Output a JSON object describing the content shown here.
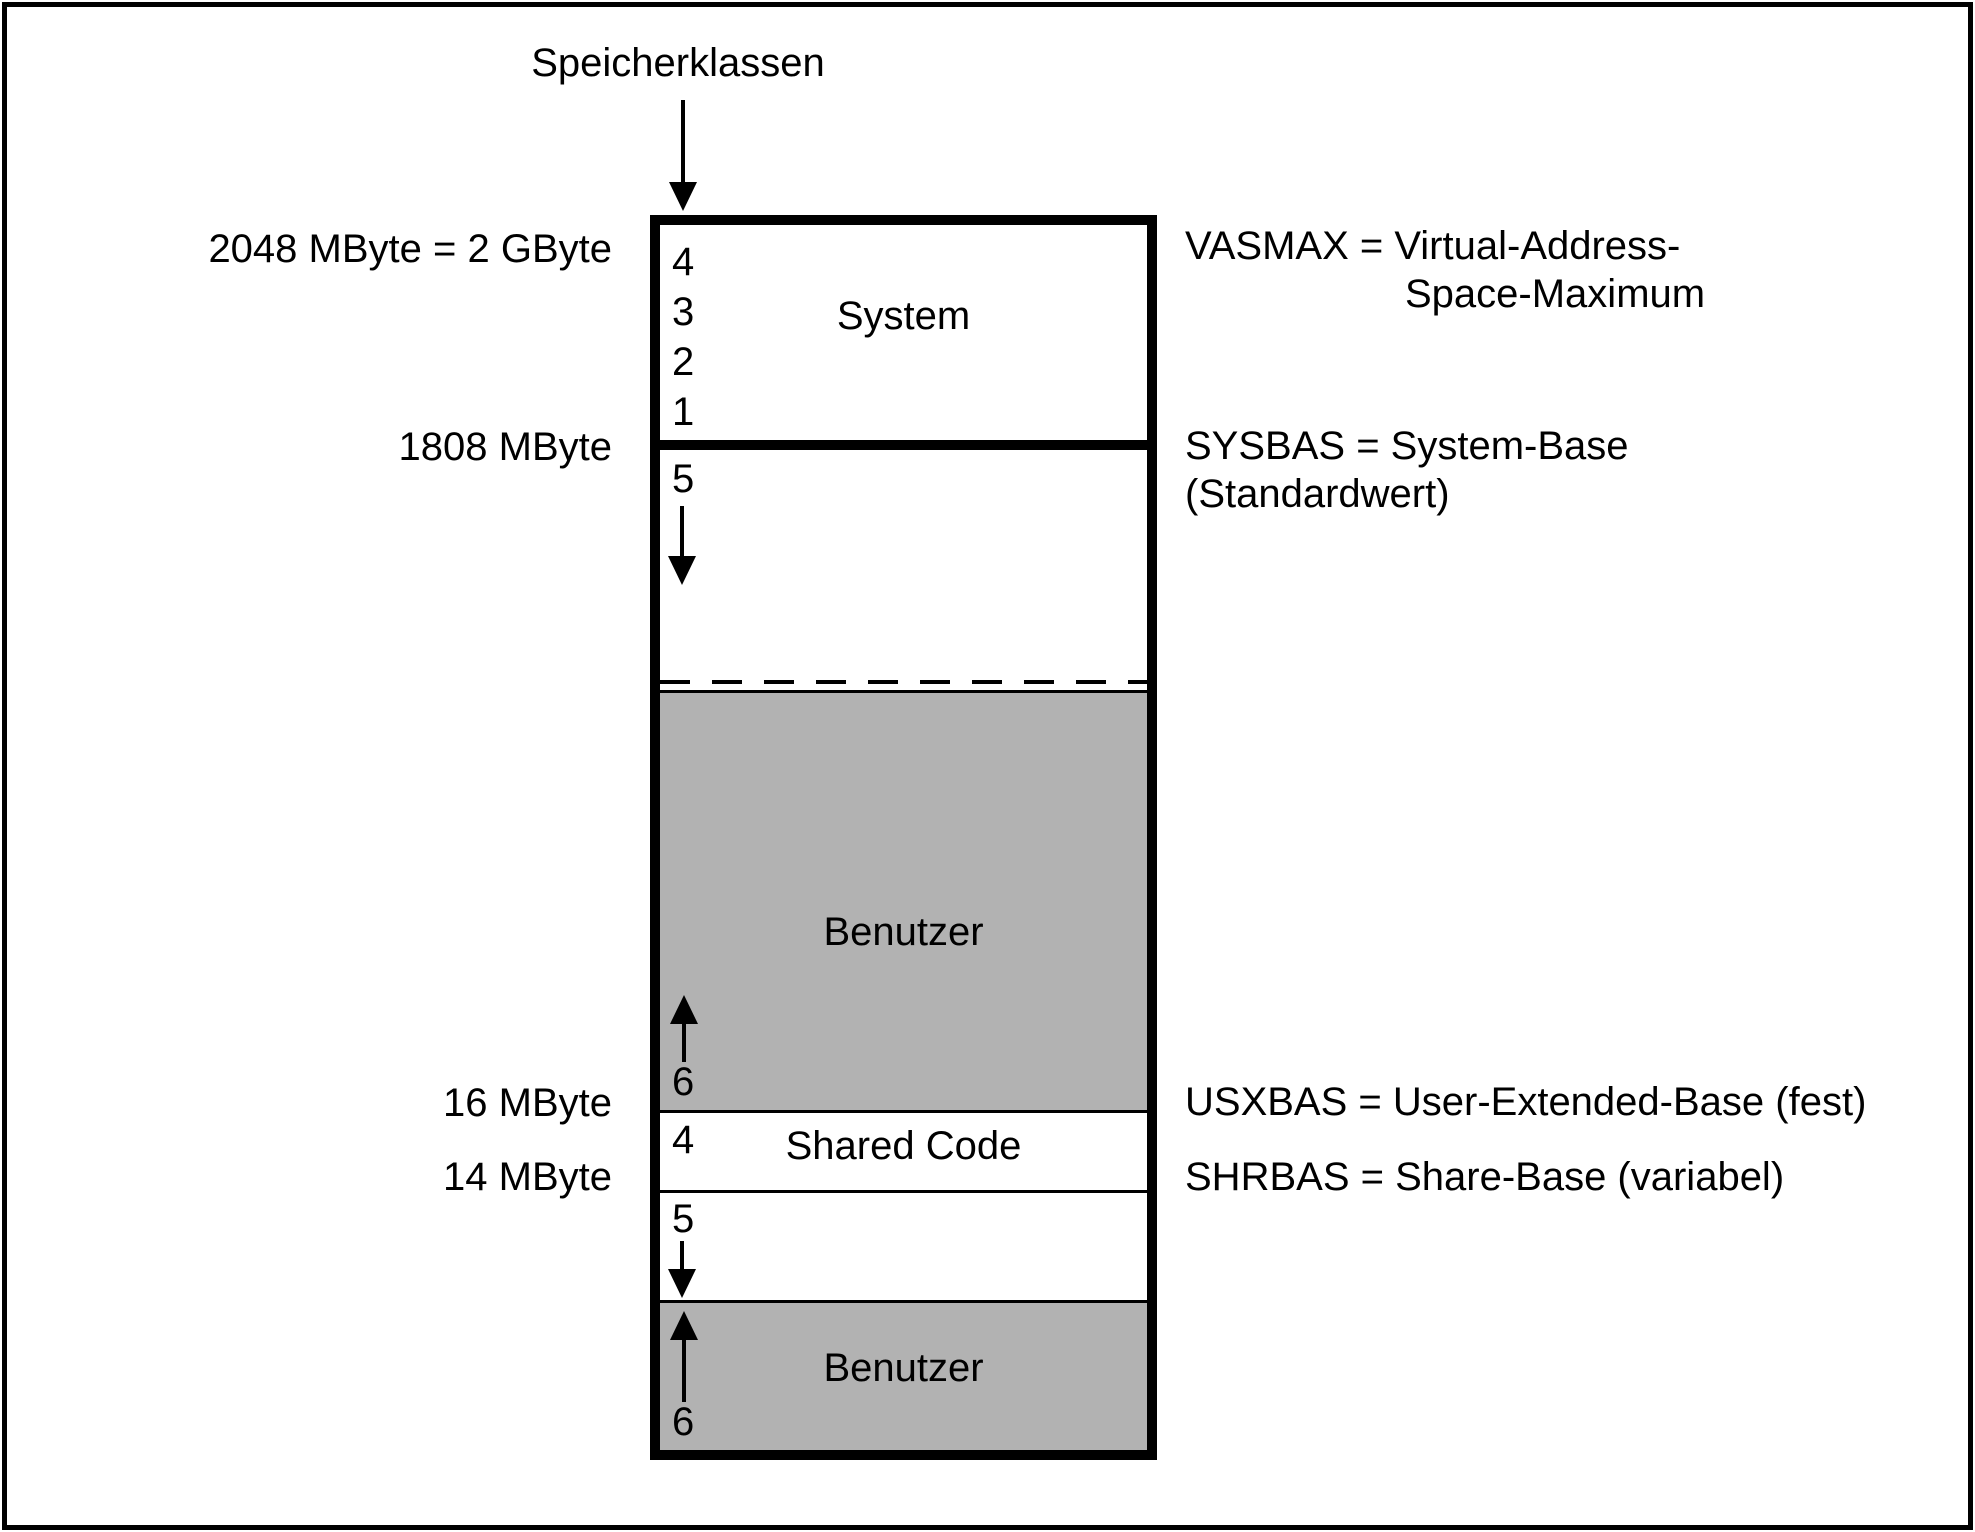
{
  "diagram": {
    "title": "Speicherklassen",
    "colors": {
      "benutzer_gray": "#b2b2b2",
      "line_black": "#000000",
      "background_white": "#ffffff"
    },
    "memory_map": {
      "sections": [
        {
          "name": "system",
          "label": "System",
          "memory_classes": [
            "4",
            "3",
            "2",
            "1"
          ],
          "fill": "white"
        },
        {
          "name": "class5-upper",
          "memory_class": "5",
          "arrow": "down",
          "fill": "white"
        },
        {
          "name": "benutzer-upper",
          "label": "Benutzer",
          "memory_class": "6",
          "arrow": "up",
          "fill": "gray"
        },
        {
          "name": "shared-code",
          "label": "Shared Code",
          "memory_class": "4",
          "fill": "white"
        },
        {
          "name": "class5-lower",
          "memory_class": "5",
          "arrow": "down",
          "fill": "white"
        },
        {
          "name": "benutzer-lower",
          "label": "Benutzer",
          "memory_class": "6",
          "arrow": "up",
          "fill": "gray"
        }
      ]
    },
    "left_labels": [
      "2048 MByte = 2 GByte",
      "1808 MByte",
      "16 MByte",
      "14 MByte"
    ],
    "right_labels": [
      {
        "line1": "VASMAX = Virtual-Address-",
        "line2": "Space-Maximum"
      },
      {
        "line1": "SYSBAS = System-Base",
        "line2": "(Standardwert)"
      },
      {
        "line1": "USXBAS = User-Extended-Base (fest)",
        "line2": ""
      },
      {
        "line1": "SHRBAS = Share-Base (variabel)",
        "line2": ""
      }
    ]
  }
}
